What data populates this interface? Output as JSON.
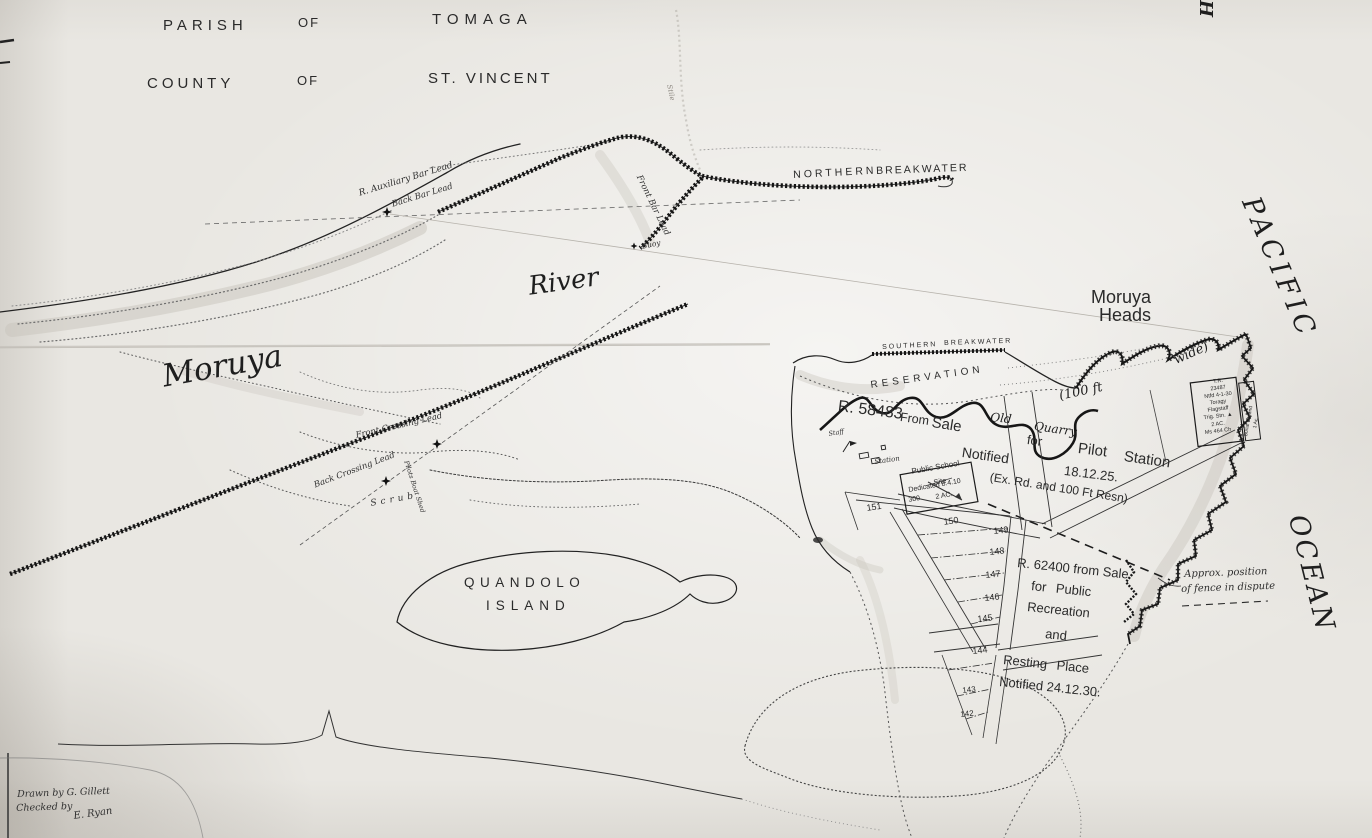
{
  "map": {
    "title": {
      "parish": "PARISH",
      "of1": "OF",
      "tomaga": "TOMAGA",
      "county": "COUNTY",
      "of2": "OF",
      "st_vincent": "ST. VINCENT"
    },
    "water": {
      "river": "River",
      "moruya": "Moruya",
      "pacific": "PACIFIC",
      "ocean": "OCEAN"
    },
    "heads": {
      "l1": "Moruya",
      "l2": "Heads"
    },
    "breakwaters": {
      "n1": "NORTHERN",
      "n2": "BREAKWATER",
      "s1": "SOUTHERN",
      "s2": "BREAKWATER"
    },
    "leads": {
      "aux_bar": "R. Auxiliary Bar Lead",
      "back_bar": "Back Bar Lead",
      "front_bar": "Front Bar Lead",
      "buoy": "Buoy",
      "front_crossing": "Front Crossing Lead",
      "back_crossing": "Back Crossing Lead",
      "boat_shed": "Pilots Boat Shed"
    },
    "r58483": {
      "no": "R. 58483",
      "from": "From",
      "sale": "Sale",
      "notified": "Notified",
      "old": "Old",
      "quarry": "Quarry",
      "for": "for",
      "pilot": "Pilot",
      "station": "Station",
      "date": "18.12.25.",
      "ex_rd": "(Ex. Rd. and 100 Ft Resn)"
    },
    "reservation": {
      "label": "RESERVATION",
      "ft100": "(100 ft",
      "wide": "wide)"
    },
    "pilot": {
      "staff": "Staff",
      "station": "Station"
    },
    "school": {
      "l1": "Public School",
      "l2": "Site",
      "l3": "Dedicated 8.4.10",
      "l4a": "300",
      "l4b": "2 AC."
    },
    "tr_box": [
      "T.R.",
      "23487",
      "Ntfd 4-1-30",
      "Toragy",
      "Flagstaff",
      "Trig. Stn. ▲",
      "2 AC.",
      "Ms 464 Ch"
    ],
    "burial": {
      "l1": "Burial Ground",
      "l2": "1 Ac."
    },
    "lots": [
      "151",
      "150",
      "149",
      "148",
      "147",
      "146",
      "145",
      "144",
      "143",
      "142"
    ],
    "r62400": [
      "R. 62400 from Sale",
      "for Public",
      "Recreation",
      "and",
      "Resting Place",
      "Notified 24.12.30."
    ],
    "fence": {
      "l1": "Approx. position",
      "l2": "of fence in dispute"
    },
    "island": {
      "l1": "QUANDOLO",
      "l2": "ISLAND"
    },
    "credits": {
      "drawn": "Drawn by G. Gillett",
      "checked": "Checked by",
      "signature": "E. Ryan"
    },
    "misc": {
      "corner_h": "H",
      "stile": "Stile",
      "scrub": "Scrub"
    },
    "colors": {
      "paper": "#e9e7e2",
      "ink": "#1c1c1c",
      "wash": "#c7c3bb"
    }
  }
}
